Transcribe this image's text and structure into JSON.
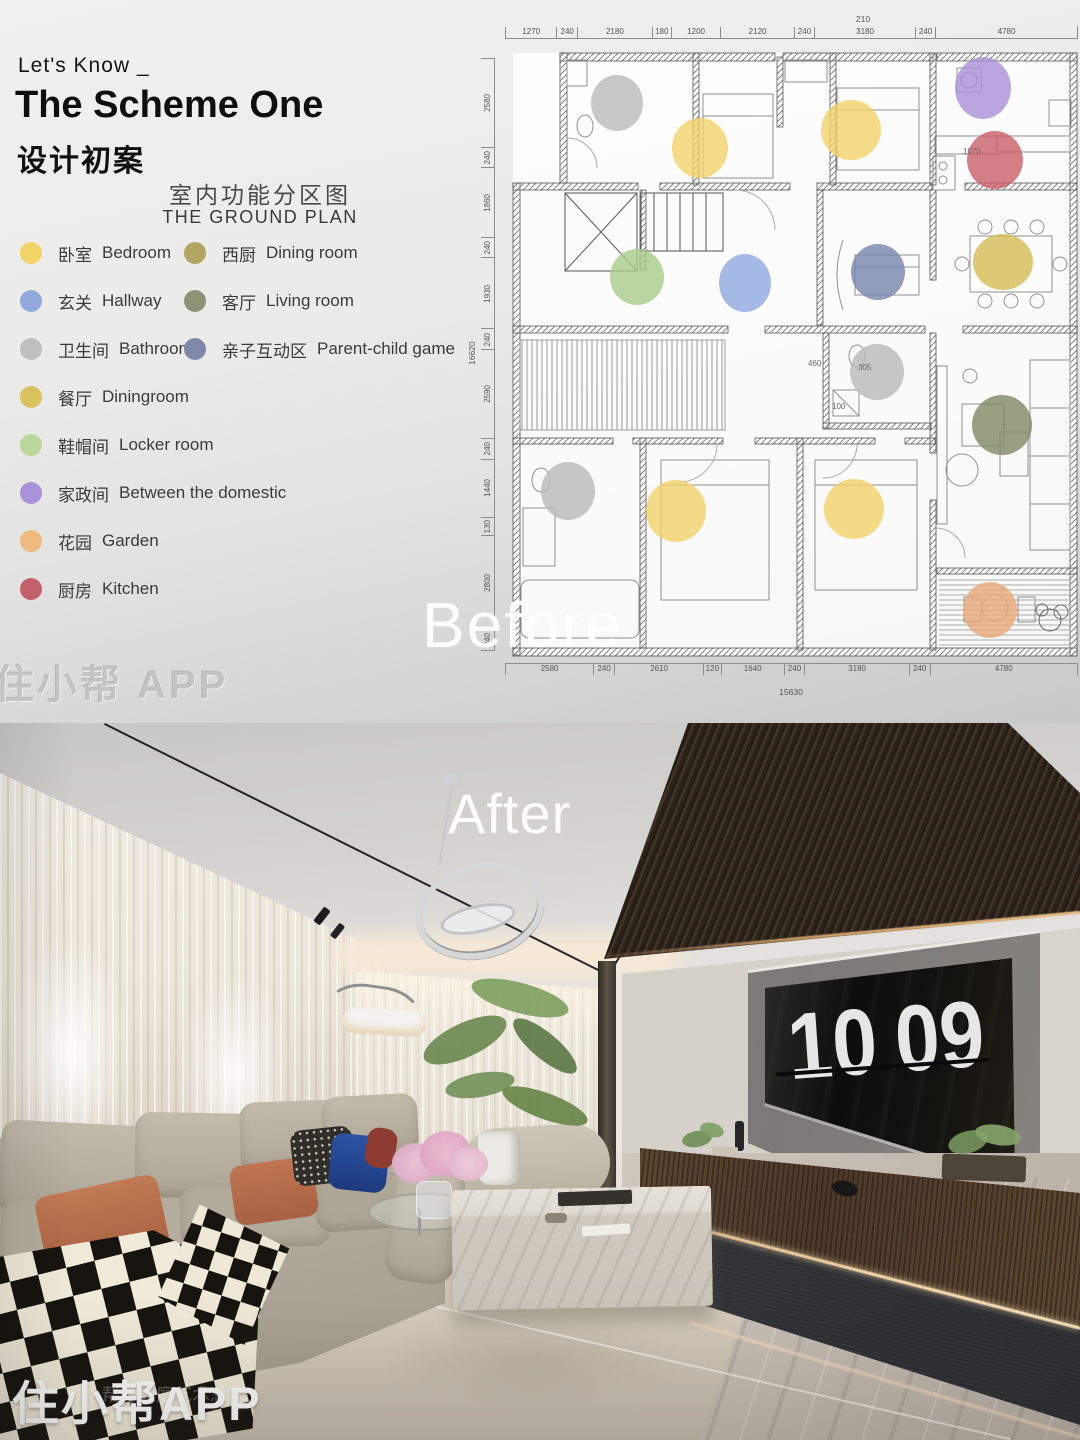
{
  "before": {
    "kicker": "Let's Know _",
    "title": "The Scheme One",
    "subtitle": "设计初案",
    "plan_title_cn": "室内功能分区图",
    "plan_title_en": "THE GROUND PLAN",
    "overlay_label": "Before",
    "watermark": "住小帮 APP",
    "legend_left": [
      {
        "cn": "卧室",
        "en": "Bedroom",
        "color": "#f1d369"
      },
      {
        "cn": "玄关",
        "en": "Hallway",
        "color": "#93a9de"
      },
      {
        "cn": "卫生间",
        "en": "Bathroom",
        "color": "#bfbfbf"
      },
      {
        "cn": "餐厅",
        "en": "Diningroom",
        "color": "#d8c35e"
      },
      {
        "cn": "鞋帽间",
        "en": "Locker room",
        "color": "#b9d79b"
      },
      {
        "cn": "家政间",
        "en": "Between the domestic",
        "color": "#a992d9"
      },
      {
        "cn": "花园",
        "en": "Garden",
        "color": "#efba7e"
      },
      {
        "cn": "厨房",
        "en": "Kitchen",
        "color": "#c2606a"
      }
    ],
    "legend_right": [
      {
        "cn": "西厨",
        "en": "Dining room",
        "color": "#b2a662"
      },
      {
        "cn": "客厅",
        "en": "Living room",
        "color": "#8e9376"
      },
      {
        "cn": "亲子互动区",
        "en": "Parent-child game",
        "color": "#7e88a8"
      }
    ],
    "plan": {
      "dim_top_total": "210",
      "dims_top": [
        "1270",
        "240",
        "2180",
        "180",
        "1200",
        "2120",
        "240",
        "3180",
        "240",
        "4780"
      ],
      "dims_bottom": [
        "2580",
        "240",
        "2610",
        "120",
        "1640",
        "240",
        "3180",
        "240",
        "4780"
      ],
      "dim_bottom_total": "15630",
      "dims_left": [
        "2580",
        "240",
        "1860",
        "240",
        "1930",
        "240",
        "2590",
        "240",
        "1440",
        "130",
        "2800",
        "240"
      ],
      "dim_left_total": "16620",
      "interior_labels": [
        {
          "text": "1070",
          "x": 498,
          "y": 139
        },
        {
          "text": "460",
          "x": 343,
          "y": 351
        },
        {
          "text": "305",
          "x": 393,
          "y": 355
        },
        {
          "text": "100",
          "x": 367,
          "y": 394
        }
      ],
      "markers": [
        {
          "name": "bathroom-topleft",
          "x": 152,
          "y": 95,
          "rx": 26,
          "ry": 28,
          "color": "#b9b9b9"
        },
        {
          "name": "bedroom-1",
          "x": 235,
          "y": 140,
          "rx": 28,
          "ry": 30,
          "color": "#f2d169"
        },
        {
          "name": "bedroom-2",
          "x": 386,
          "y": 122,
          "rx": 30,
          "ry": 30,
          "color": "#f2d169"
        },
        {
          "name": "domestic-room",
          "x": 518,
          "y": 80,
          "rx": 28,
          "ry": 31,
          "color": "#a98fd6"
        },
        {
          "name": "kitchen",
          "x": 530,
          "y": 152,
          "rx": 28,
          "ry": 29,
          "color": "#c95f66"
        },
        {
          "name": "locker-room",
          "x": 172,
          "y": 269,
          "rx": 27,
          "ry": 28,
          "color": "#a8cc8a"
        },
        {
          "name": "hallway",
          "x": 280,
          "y": 275,
          "rx": 26,
          "ry": 29,
          "color": "#8fa7de"
        },
        {
          "name": "parent-child",
          "x": 413,
          "y": 264,
          "rx": 27,
          "ry": 28,
          "color": "#7485ab"
        },
        {
          "name": "dining-west",
          "x": 538,
          "y": 254,
          "rx": 30,
          "ry": 28,
          "color": "#d3bb55"
        },
        {
          "name": "bathroom-middle",
          "x": 412,
          "y": 364,
          "rx": 27,
          "ry": 28,
          "color": "#b9b9b9"
        },
        {
          "name": "living-room",
          "x": 537,
          "y": 417,
          "rx": 30,
          "ry": 30,
          "color": "#7e8a63"
        },
        {
          "name": "bathroom-bottom",
          "x": 103,
          "y": 483,
          "rx": 27,
          "ry": 29,
          "color": "#b9b9b9"
        },
        {
          "name": "bedroom-3",
          "x": 211,
          "y": 503,
          "rx": 30,
          "ry": 31,
          "color": "#f2d169"
        },
        {
          "name": "bedroom-4",
          "x": 389,
          "y": 501,
          "rx": 30,
          "ry": 30,
          "color": "#f2d169"
        },
        {
          "name": "garden",
          "x": 525,
          "y": 602,
          "rx": 27,
          "ry": 28,
          "color": "#e8a877"
        }
      ]
    }
  },
  "after": {
    "overlay_label": "After",
    "clock_hours": "10",
    "clock_minutes": "09",
    "watermark": "住小帮APP",
    "watermark_small": "住小帮@家庭艺术总部"
  }
}
